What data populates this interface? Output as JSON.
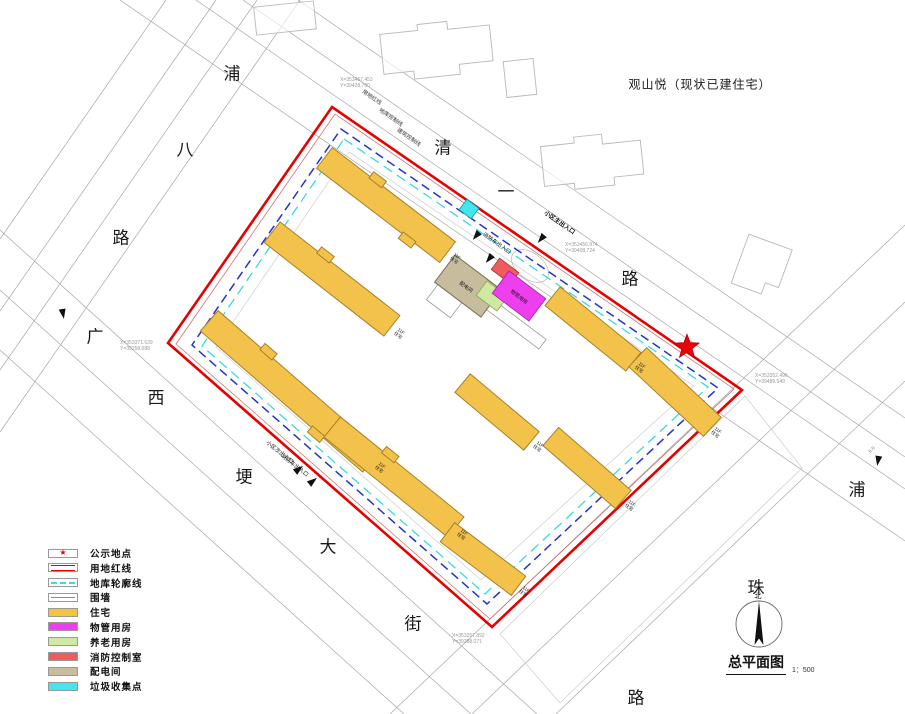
{
  "header": {
    "existing_building_note": "观山悦（现状已建住宅）"
  },
  "streets": {
    "pu_ba_lu": {
      "name": "浦八路",
      "chars": [
        "浦",
        "八",
        "路"
      ]
    },
    "qing_yi_lu": {
      "name": "清一路",
      "chars": [
        "清",
        "一",
        "路"
      ]
    },
    "guang_xi_geng_da_jie": {
      "name": "广西埂大街",
      "chars": [
        "广",
        "西",
        "埂",
        "大",
        "街"
      ]
    },
    "pu_zhu_lu": {
      "name": "浦珠路",
      "chars": [
        "浦",
        "珠",
        "路"
      ]
    }
  },
  "boundary_labels": {
    "red_line": "用地红线",
    "garage_control": "地库控制线",
    "building_control": "建筑控制线"
  },
  "entrances": {
    "main": "小区主出入口",
    "fire_north": "消防车出入口",
    "secondary": "小区次出入口",
    "fire_south": "消防车出入口"
  },
  "coordinates": [
    {
      "x": "X=353467.453",
      "y": "Y=39428.700"
    },
    {
      "x": "X=353456.974",
      "y": "Y=39408.724"
    },
    {
      "x": "X=353371.639",
      "y": "Y=39258.088"
    },
    {
      "x": "X=353257.892",
      "y": "Y=39288.071"
    },
    {
      "x": "X=353352.496",
      "y": "Y=39489.549"
    }
  ],
  "building_label": {
    "floors": "11F",
    "type": "住宅"
  },
  "facilities": {
    "power_room": "配电间",
    "property_room": "物管用房"
  },
  "dimension_labels": {
    "d1": "6.8"
  },
  "legend": {
    "items": [
      {
        "label": "公示地点",
        "swatch": "star",
        "color": "#e8000b"
      },
      {
        "label": "用地红线",
        "swatch": "double-line",
        "color": "#e60000"
      },
      {
        "label": "地库轮廓线",
        "swatch": "dashed-line",
        "color": "#35dde8"
      },
      {
        "label": "围墙",
        "swatch": "thin-line",
        "color": "#e06666"
      },
      {
        "label": "住宅",
        "swatch": "fill",
        "color": "#f5c33c"
      },
      {
        "label": "物管用房",
        "swatch": "fill",
        "color": "#ee3fee"
      },
      {
        "label": "养老用房",
        "swatch": "fill",
        "color": "#cfe9a2"
      },
      {
        "label": "消防控制室",
        "swatch": "fill",
        "color": "#f05c5c"
      },
      {
        "label": "配电间",
        "swatch": "fill",
        "color": "#c7bd9e"
      },
      {
        "label": "垃圾收集点",
        "swatch": "fill",
        "color": "#43e6ee"
      }
    ]
  },
  "titleblock": {
    "title": "总平面图",
    "scale": "1：500",
    "north": "北"
  }
}
